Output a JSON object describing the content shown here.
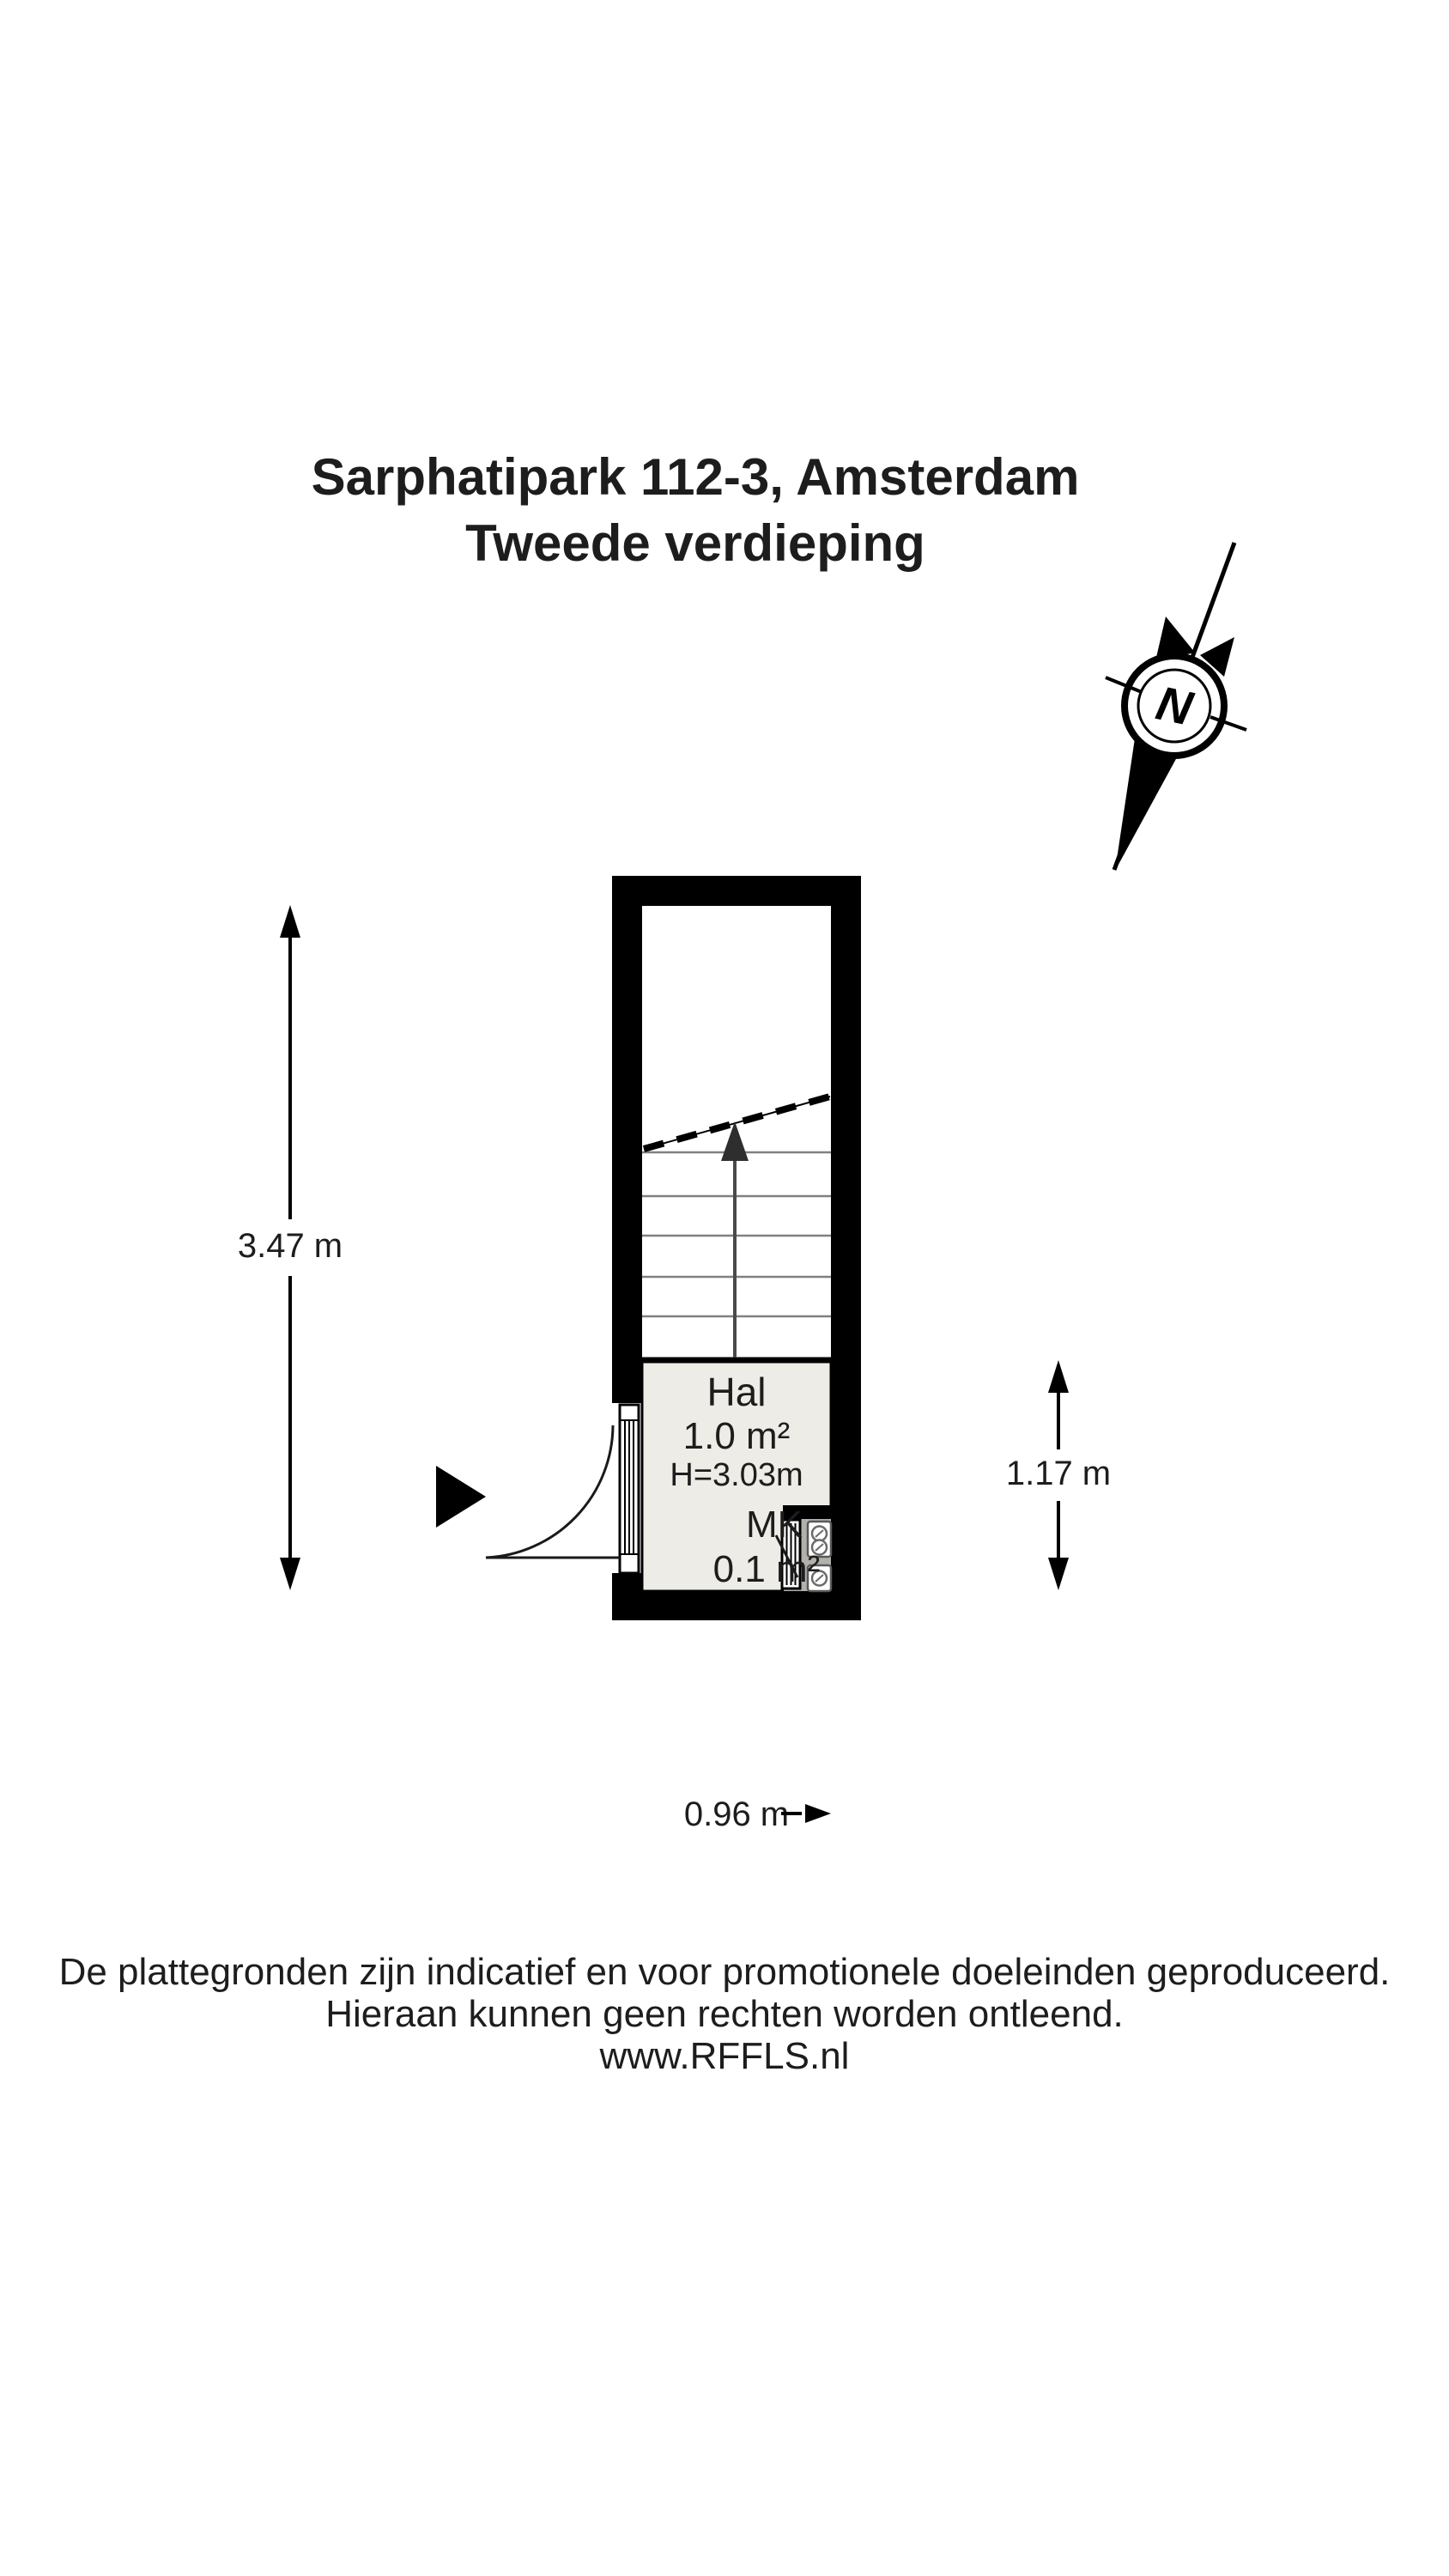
{
  "title": {
    "line1": "Sarphatipark 112-3, Amsterdam",
    "line2": "Tweede verdieping"
  },
  "compass": {
    "label": "N"
  },
  "rooms": {
    "hal": {
      "name": "Hal",
      "area": "1.0 m²",
      "ceiling_height": "H=3.03m"
    },
    "mk": {
      "name": "MK",
      "area": "0.1 m²"
    }
  },
  "dimensions": {
    "left_height": "3.47 m",
    "right_height": "1.17 m",
    "bottom_width": "0.96 m"
  },
  "footer": {
    "line1": "De plattegronden zijn indicatief en voor promotionele doeleinden geproduceerd.",
    "line2": "Hieraan kunnen geen rechten worden ontleend.",
    "line3": "www.RFFLS.nl"
  },
  "colors": {
    "wall": "#000000",
    "floor": "#edece6",
    "mk": "#b2b0ab",
    "tread": "#808080",
    "ink": "#1d1d1d"
  }
}
